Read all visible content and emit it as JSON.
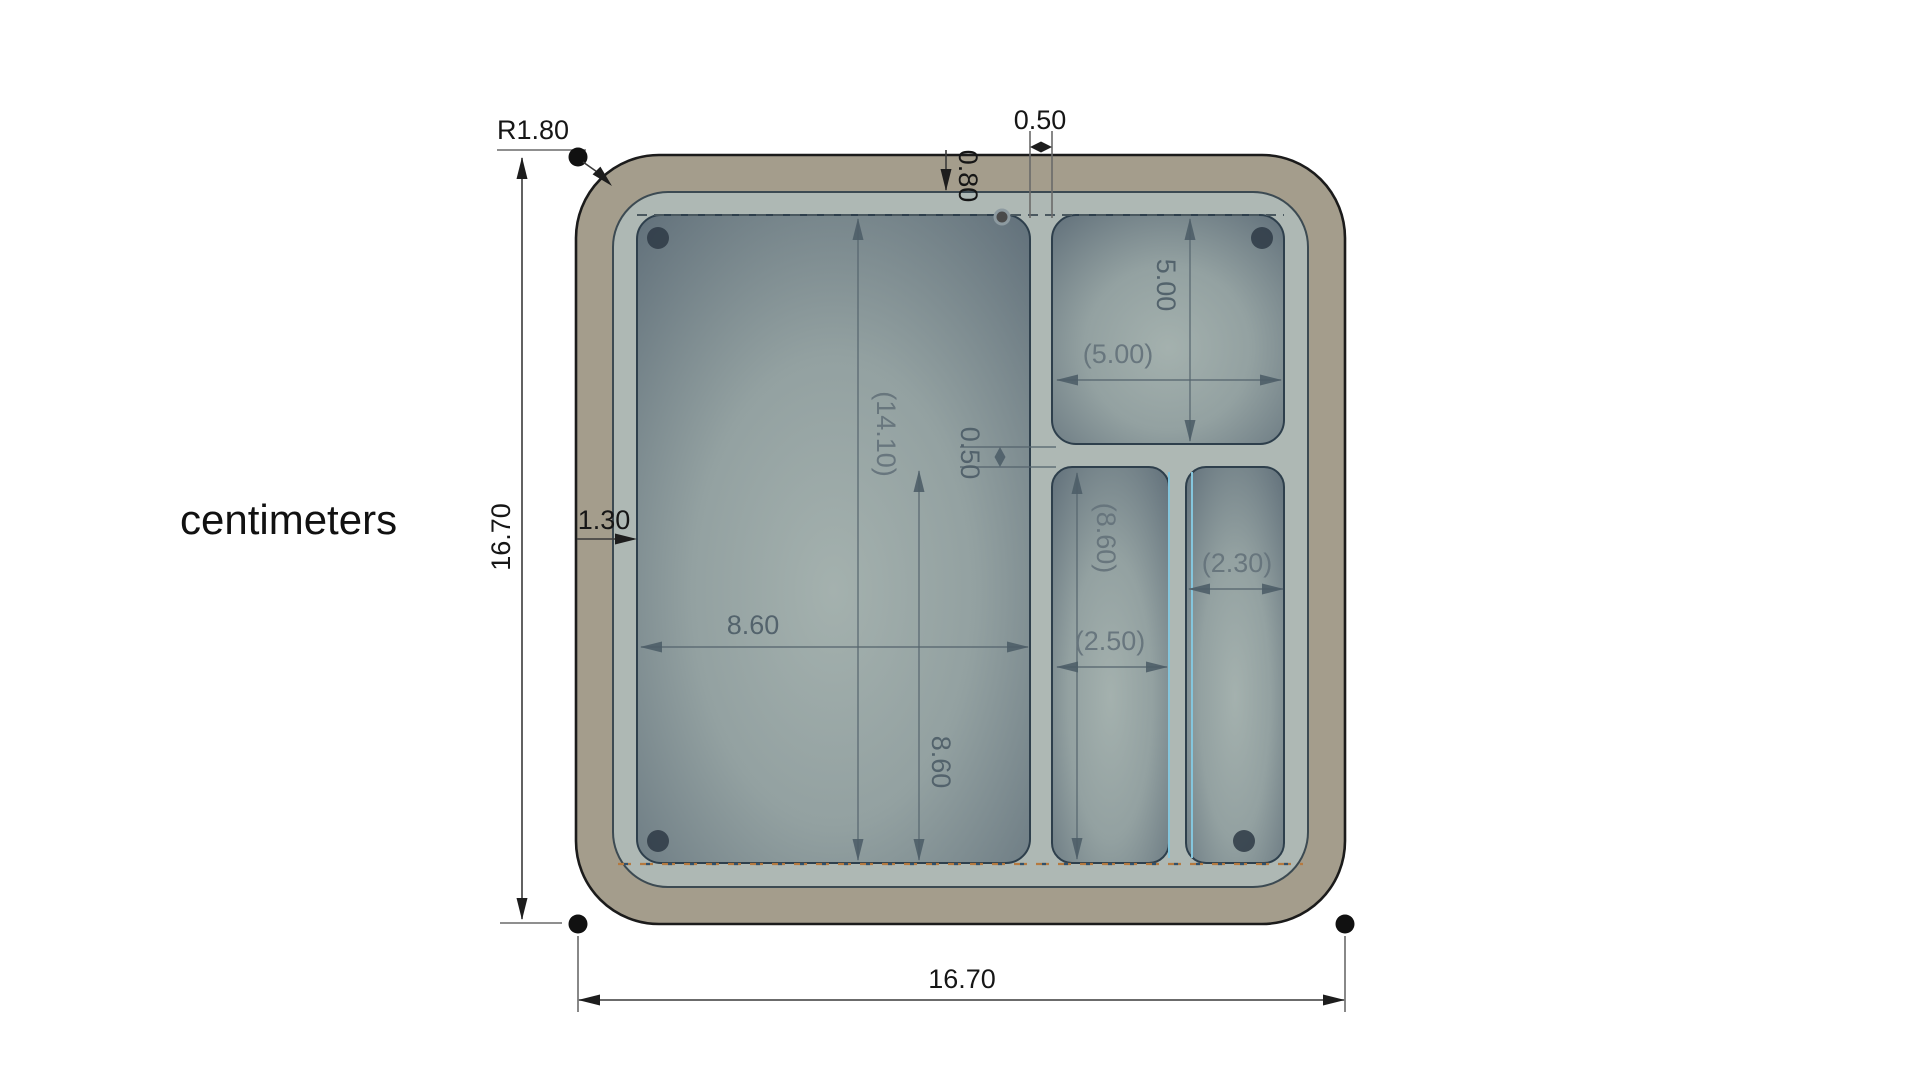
{
  "canvas": {
    "units_label": "centimeters",
    "dims": {
      "corner_radius": "R1.80",
      "outer_height": "16.70",
      "outer_width": "16.70",
      "top_divider_thickness": "0.50",
      "top_wall_thickness": "0.80",
      "left_wall_thickness": "1.30",
      "main_pocket_width": "8.60",
      "main_pocket_height": "8.60",
      "main_pocket_ref": "(14.10)",
      "mid_divider_thickness": "0.50",
      "top_right_pocket_height": "5.00",
      "top_right_pocket_width_ref": "(5.00)",
      "bottom_mid_pocket_ref": "(8.60)",
      "bottom_mid_pocket_width_ref": "(2.50)",
      "bottom_right_pocket_width_ref": "(2.30)"
    },
    "colors": {
      "outer_wall": "#a49d8c",
      "tray_floor": "#aeb8b4",
      "pocket_dark": "#5d6c77",
      "pocket_light": "#a4b1ae",
      "outline": "#1b1b1b",
      "hidden_edge_orange": "#b5793f",
      "highlight_edge_blue": "#85c6dd",
      "dimension_text_dark": "#161616",
      "dimension_text_gray": "#4e5e68"
    }
  }
}
